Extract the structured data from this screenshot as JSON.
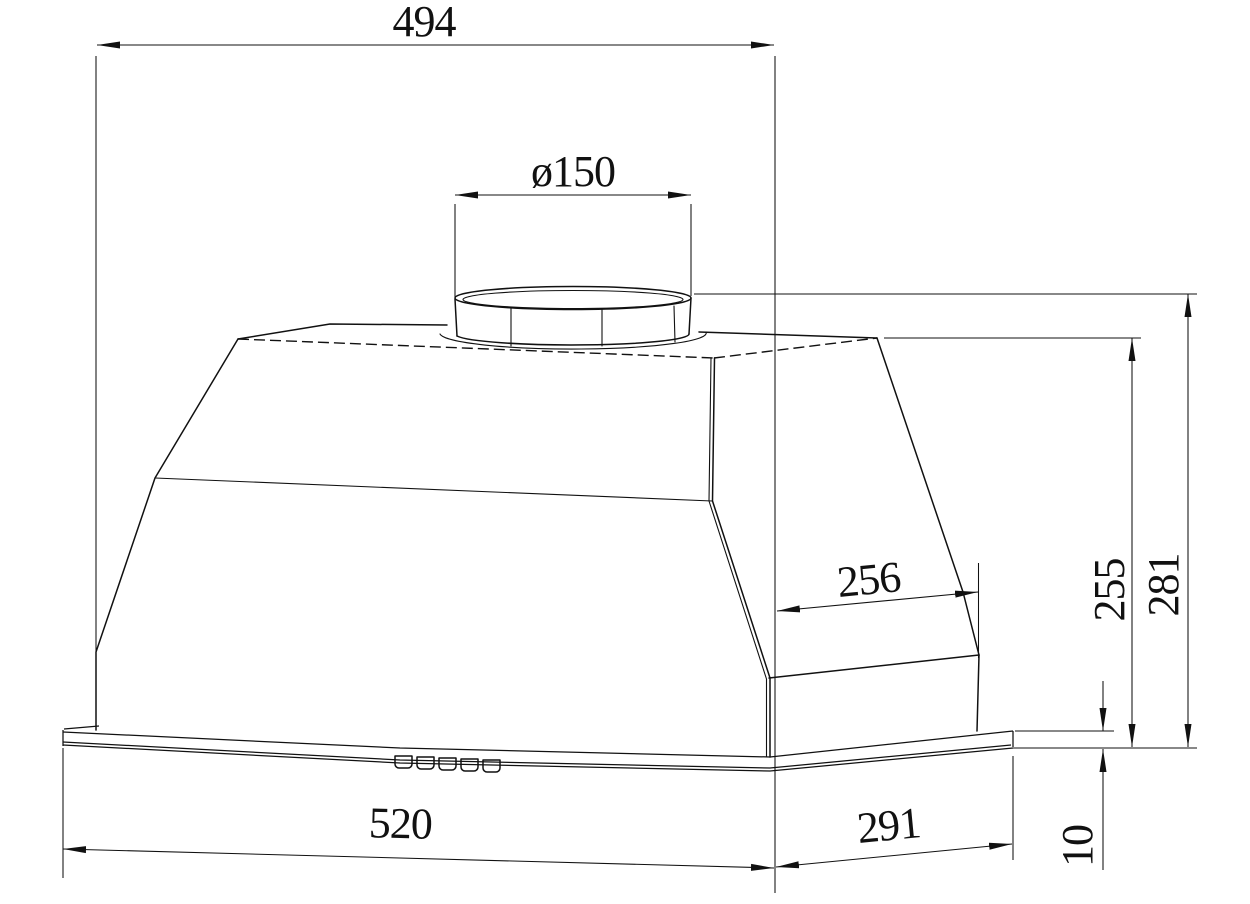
{
  "figure": {
    "type": "technical-drawing",
    "subject": "built-in range hood, front perspective with dimensions",
    "line_color": "#111111",
    "background_color": "#ffffff",
    "dimensions": {
      "top_width": "494",
      "duct_diameter": "ø150",
      "side_depth": "256",
      "body_height": "255",
      "overall_height": "281",
      "base_width": "520",
      "base_depth": "291",
      "base_thickness": "10"
    }
  }
}
